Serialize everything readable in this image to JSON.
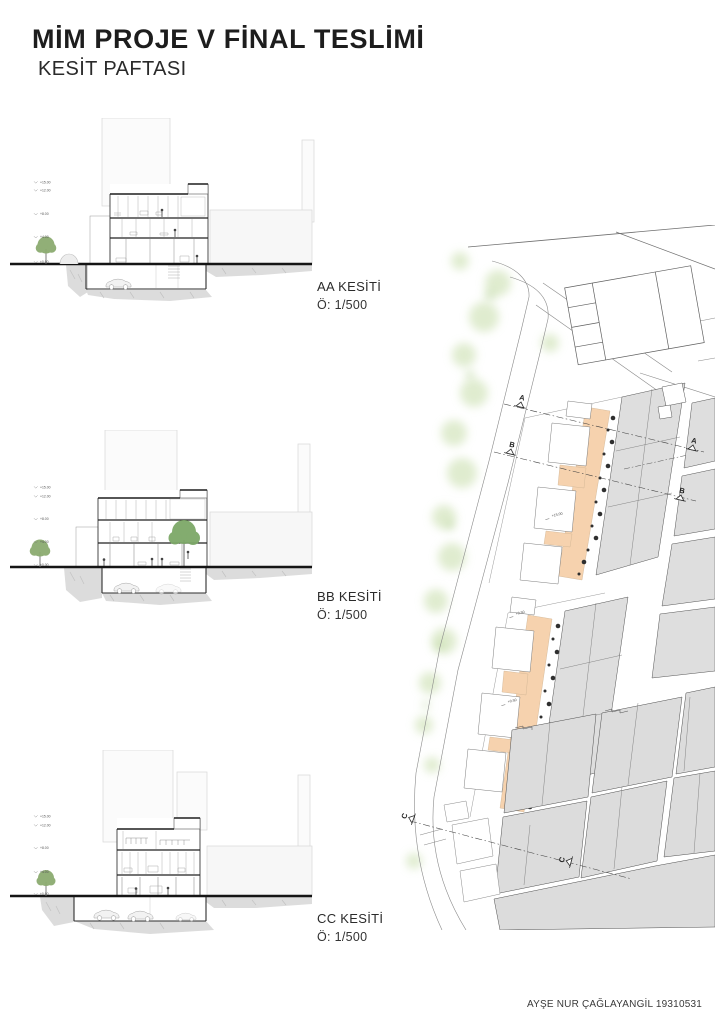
{
  "header": {
    "title": "MİM PROJE V FİNAL TESLİMİ",
    "subtitle": "KESİT PAFTASI"
  },
  "sections": [
    {
      "id": "AA",
      "label": "AA KESİTİ",
      "scale": "Ö: 1/500",
      "elevation_labels": [
        "+15.00",
        "+12.00",
        "+8.00",
        "+4.00",
        "±0.00"
      ]
    },
    {
      "id": "BB",
      "label": "BB KESİTİ",
      "scale": "Ö: 1/500",
      "elevation_labels": [
        "+15.00",
        "+12.00",
        "+8.00",
        "+4.00",
        "±0.00"
      ]
    },
    {
      "id": "CC",
      "label": "CC KESİTİ",
      "scale": "Ö: 1/500",
      "elevation_labels": [
        "+15.00",
        "+12.00",
        "+8.00",
        "+4.00",
        "±0.00"
      ]
    }
  ],
  "site_plan": {
    "markers": [
      {
        "label": "A"
      },
      {
        "label": "B"
      },
      {
        "label": "A"
      },
      {
        "label": "B"
      },
      {
        "label": "C"
      },
      {
        "label": "C"
      }
    ],
    "annotations": [
      {
        "text": "+15.00"
      },
      {
        "text": "+0.50"
      },
      {
        "text": "+0.50"
      }
    ],
    "colors": {
      "project_fill": "#f6d2ae",
      "context_fill": "#dedede",
      "vegetation": "#cfe2b6",
      "tree_dot": "#2f2f2f"
    }
  },
  "footer": {
    "credit": "AYŞE NUR ÇAĞLAYANGİL 19310531"
  }
}
